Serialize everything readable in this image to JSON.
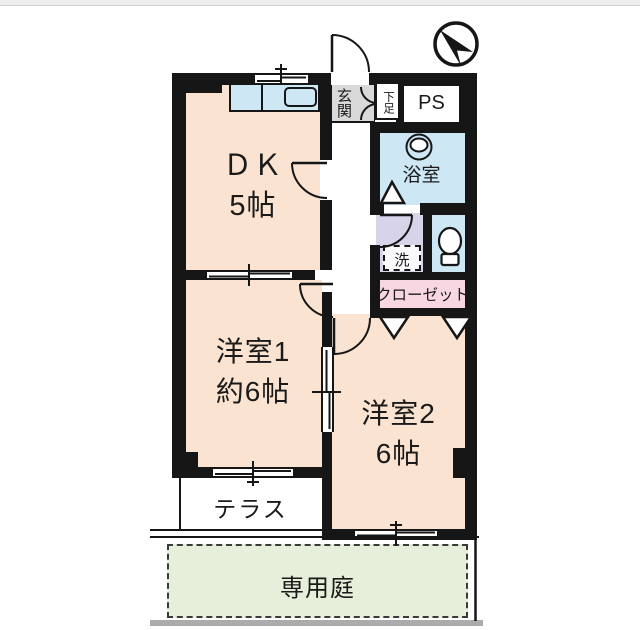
{
  "plan": {
    "rooms": {
      "dk": {
        "name": "ＤＫ",
        "size": "5帖"
      },
      "western1": {
        "name": "洋室1",
        "size": "約6帖"
      },
      "western2": {
        "name": "洋室2",
        "size": "6帖"
      }
    },
    "labels": {
      "entrance": "玄関",
      "shoe_box": "下足",
      "pipe_space": "PS",
      "bathroom": "浴室",
      "laundry": "洗",
      "closet": "クローゼット",
      "terrace": "テラス",
      "private_garden": "専用庭"
    },
    "icons": {
      "compass": "northwest-arrow"
    },
    "colors": {
      "wall": "#161616",
      "room_peach": "#fae3d0",
      "water_blue": "#cde7f4",
      "laundry_lavender": "#d7d3e9",
      "closet_pink": "#f8d7e3",
      "garden_green": "#e6efda",
      "entrance_gray": "#d9d9d9",
      "top_strip": "#ededed",
      "bottom_bar": "#ababab"
    }
  }
}
